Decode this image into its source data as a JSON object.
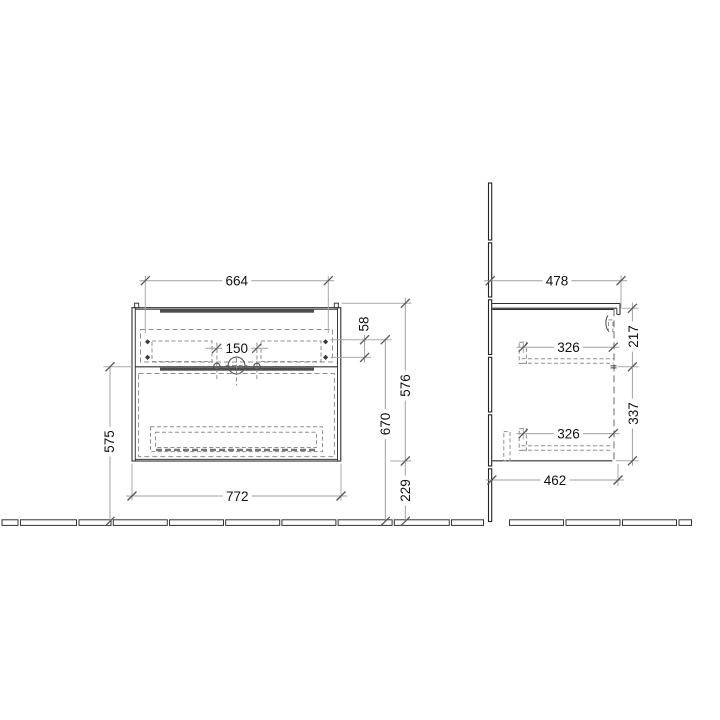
{
  "drawing": {
    "front_view": {
      "dimensions": {
        "top_width": "664",
        "tap_hole_spacing": "150",
        "fixing_offset": "58",
        "body_height": "576",
        "fixing_height": "670",
        "floor_clearance": "229",
        "front_height": "575",
        "bottom_width": "772"
      }
    },
    "side_view": {
      "dimensions": {
        "top_depth": "478",
        "upper_front_height": "217",
        "upper_rail_length": "326",
        "lower_front_height": "337",
        "lower_rail_length": "326",
        "bottom_depth": "462"
      }
    }
  }
}
